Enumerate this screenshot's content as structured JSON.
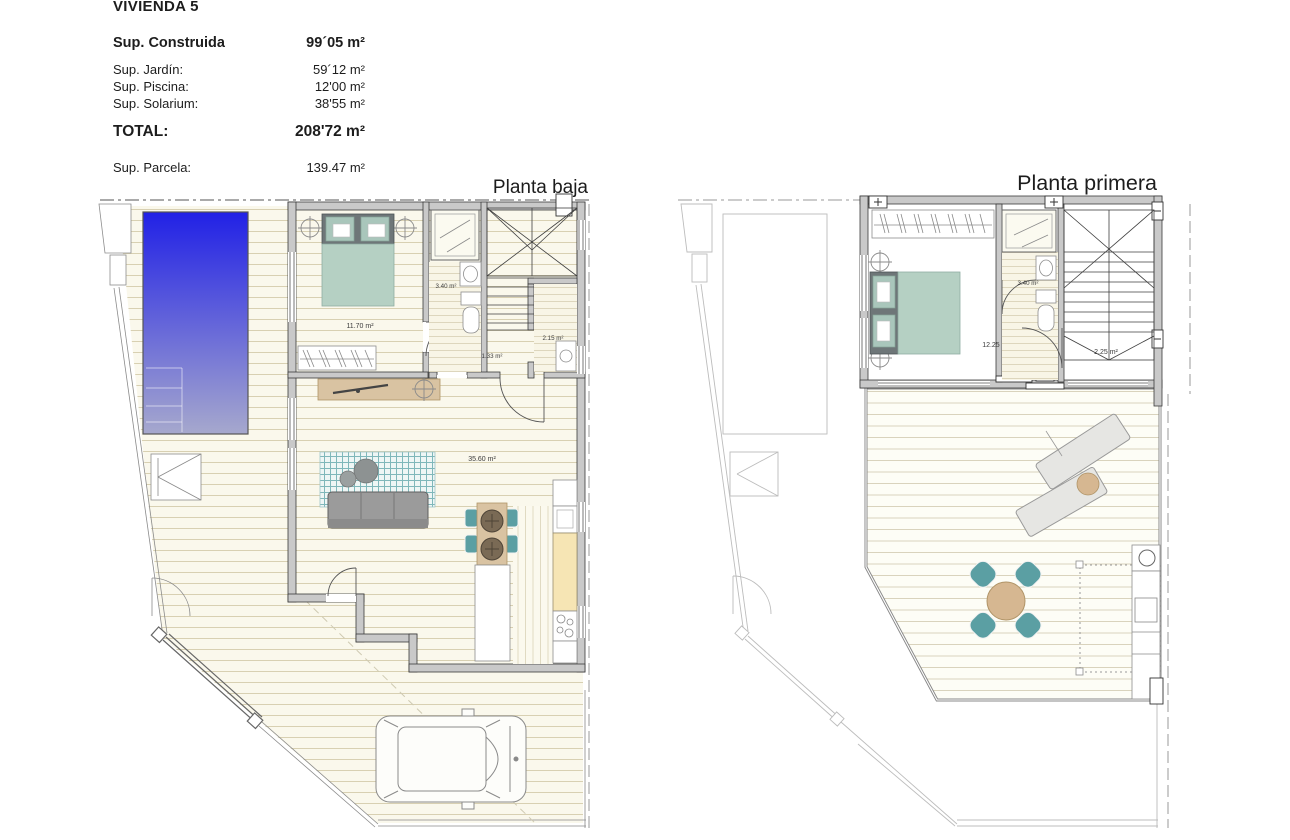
{
  "summary": {
    "title": "VIVIENDA 5",
    "construida_label": "Sup. Construida",
    "construida_value": "99´05 m²",
    "jardin_label": "Sup. Jardín:",
    "jardin_value": "59´12 m²",
    "piscina_label": "Sup. Piscina:",
    "piscina_value": "12'00 m²",
    "solarium_label": "Sup. Solarium:",
    "solarium_value": "38'55 m²",
    "total_label": "TOTAL:",
    "total_value": "208'72 m²",
    "parcela_label": "Sup. Parcela:",
    "parcela_value": "139.47 m²"
  },
  "plans": {
    "baja": {
      "label": "Planta baja",
      "rooms": {
        "bedroom": "11.70 m²",
        "bathroom": "3.40 m²",
        "hall": "1.33 m²",
        "laundry": "2.15 m²",
        "living": "35.60 m²"
      }
    },
    "primera": {
      "label": "Planta primera",
      "rooms": {
        "bedroom": "12.25 m²",
        "bathroom": "3.40 m²",
        "hall": "2.25 m²"
      }
    }
  },
  "colors": {
    "pool_top": "#2121e6",
    "pool_bottom": "#a6a8cd",
    "wall_fill": "#c9c9c9",
    "wood": "#d9c3a2",
    "teal": "#5b9fa3",
    "bed_mattress": "#b5d0c3",
    "counter": "#f6e5b4"
  }
}
